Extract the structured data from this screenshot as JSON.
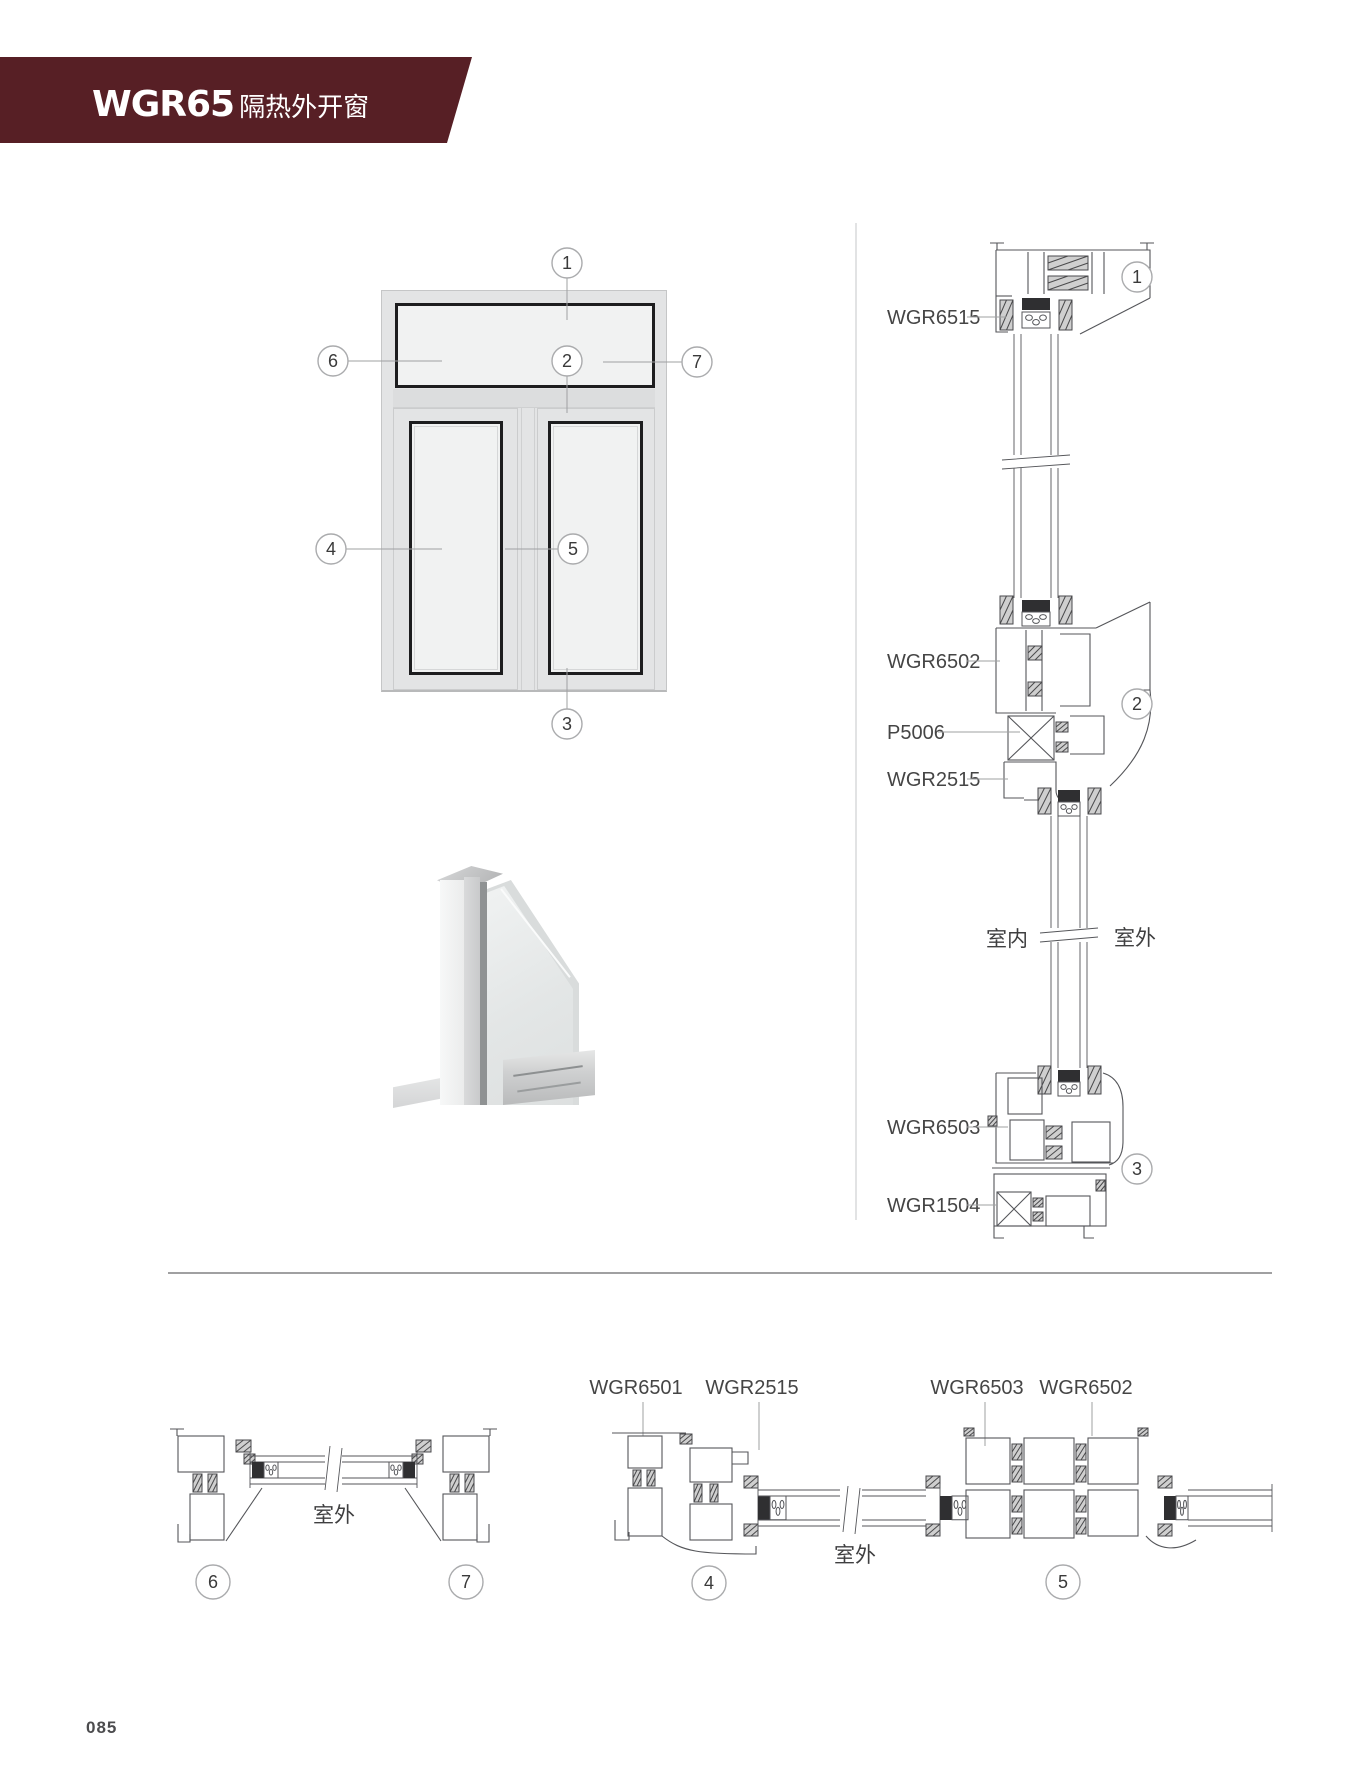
{
  "page": {
    "number": "085"
  },
  "header": {
    "model": "WGR65",
    "subtitle": "隔热外开窗",
    "banner_color": "#571f25",
    "text_color": "#ffffff"
  },
  "colors": {
    "drawing_line": "#55565a",
    "frame_fill": "#e3e4e5",
    "glass_fill": "#f1f2f2",
    "vent_border": "#1d1d1f",
    "leader": "#9fa0a2"
  },
  "elevation": {
    "callouts": {
      "c1": "1",
      "c2": "2",
      "c3": "3",
      "c4": "4",
      "c5": "5",
      "c6": "6",
      "c7": "7"
    }
  },
  "vertical_section": {
    "labels": {
      "head": "WGR6515",
      "transom": "WGR6502",
      "reinforcement": "P5006",
      "adapter": "WGR2515",
      "sash_bottom": "WGR6503",
      "sill": "WGR1504"
    },
    "callouts": {
      "top": "1",
      "middle": "2",
      "bottom": "3"
    },
    "indoor": "室内",
    "outdoor": "室外"
  },
  "bottom_left_section": {
    "outdoor": "室外",
    "callouts": {
      "left": "6",
      "right": "7"
    }
  },
  "bottom_right_section": {
    "labels": {
      "frame": "WGR6501",
      "adapter": "WGR2515",
      "sash_left": "WGR6503",
      "sash_right": "WGR6502"
    },
    "outdoor": "室外",
    "callouts": {
      "left": "4",
      "right": "5"
    }
  }
}
